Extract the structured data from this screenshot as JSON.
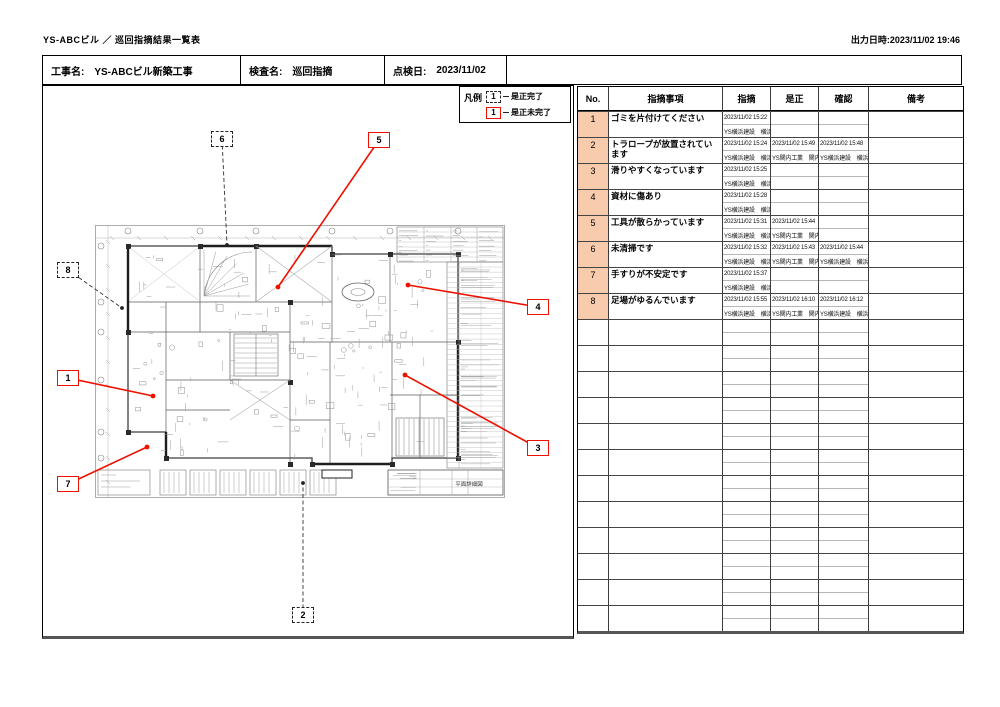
{
  "colors": {
    "accent_red": "#ee1100",
    "no_column_bg": "#f8cbad",
    "marker_dashed": "#222222"
  },
  "page": {
    "title": "YS-ABCビル ／ 巡回指摘結果一覧表",
    "printed_at": "出力日時:2023/11/02 19:46"
  },
  "info_bar": {
    "project_label": "工事名:",
    "project_value": "YS-ABCビル新築工事",
    "inspection_label": "検査名:",
    "inspection_value": "巡回指摘",
    "date_label": "点検日:",
    "date_value": "2023/11/02"
  },
  "legend": {
    "title": "凡例",
    "completed_num": "1",
    "completed_label": "是正完了",
    "incomplete_num": "1",
    "incomplete_label": "是正未完了"
  },
  "plan": {
    "title_block_text": "平面詳細図"
  },
  "table": {
    "headers": [
      "No.",
      "指摘事項",
      "指摘",
      "是正",
      "確認",
      "備考"
    ],
    "empty_row_count": 12,
    "rows": [
      {
        "no": "1",
        "item": "ゴミを片付けてください",
        "shiteki_dt": "2023/11/02 15:22",
        "shiteki_by": "YS横浜建設　横浜",
        "zesei_dt": "",
        "zesei_by": "",
        "kakunin_dt": "",
        "kakunin_by": "",
        "biko": ""
      },
      {
        "no": "2",
        "item": "トラロープが放置されています",
        "shiteki_dt": "2023/11/02 15:24",
        "shiteki_by": "YS横浜建設　横浜",
        "zesei_dt": "2023/11/02 15:49",
        "zesei_by": "YS関内工業　関内",
        "kakunin_dt": "2023/11/02 15:48",
        "kakunin_by": "YS横浜建設　横浜",
        "biko": ""
      },
      {
        "no": "3",
        "item": "滑りやすくなっています",
        "shiteki_dt": "2023/11/02 15:25",
        "shiteki_by": "YS横浜建設　横浜",
        "zesei_dt": "",
        "zesei_by": "",
        "kakunin_dt": "",
        "kakunin_by": "",
        "biko": ""
      },
      {
        "no": "4",
        "item": "資材に傷あり",
        "shiteki_dt": "2023/11/02 15:28",
        "shiteki_by": "YS横浜建設　横浜",
        "zesei_dt": "",
        "zesei_by": "",
        "kakunin_dt": "",
        "kakunin_by": "",
        "biko": ""
      },
      {
        "no": "5",
        "item": "工具が散らかっています",
        "shiteki_dt": "2023/11/02 15:31",
        "shiteki_by": "YS横浜建設　横浜",
        "zesei_dt": "2023/11/02 15:44",
        "zesei_by": "YS関内工業　関内",
        "kakunin_dt": "",
        "kakunin_by": "",
        "biko": ""
      },
      {
        "no": "6",
        "item": "未清掃です",
        "shiteki_dt": "2023/11/02 15:32",
        "shiteki_by": "YS横浜建設　横浜",
        "zesei_dt": "2023/11/02 15:43",
        "zesei_by": "YS関内工業　関内",
        "kakunin_dt": "2023/11/02 15:44",
        "kakunin_by": "YS横浜建設　横浜",
        "biko": ""
      },
      {
        "no": "7",
        "item": "手すりが不安定です",
        "shiteki_dt": "2023/11/02 15:37",
        "shiteki_by": "YS横浜建設　横浜",
        "zesei_dt": "",
        "zesei_by": "",
        "kakunin_dt": "",
        "kakunin_by": "",
        "biko": ""
      },
      {
        "no": "8",
        "item": "足場がゆるんでいます",
        "shiteki_dt": "2023/11/02 15:55",
        "shiteki_by": "YS横浜建設　横浜",
        "zesei_dt": "2023/11/02 16:10",
        "zesei_by": "YS関内工業　関内",
        "kakunin_dt": "2023/11/02 16:12",
        "kakunin_by": "YS横浜建設　横浜",
        "biko": ""
      }
    ]
  },
  "markers": [
    {
      "no": "1",
      "status": "incomplete",
      "box": {
        "x": 57,
        "y": 370
      },
      "dot": {
        "x": 153,
        "y": 396
      }
    },
    {
      "no": "2",
      "status": "completed",
      "box": {
        "x": 292,
        "y": 607
      },
      "dot": {
        "x": 303,
        "y": 483
      }
    },
    {
      "no": "3",
      "status": "incomplete",
      "box": {
        "x": 527,
        "y": 440
      },
      "dot": {
        "x": 405,
        "y": 375
      }
    },
    {
      "no": "4",
      "status": "incomplete",
      "box": {
        "x": 527,
        "y": 299
      },
      "dot": {
        "x": 408,
        "y": 285
      }
    },
    {
      "no": "5",
      "status": "incomplete",
      "box": {
        "x": 368,
        "y": 132
      },
      "dot": {
        "x": 278,
        "y": 287
      }
    },
    {
      "no": "6",
      "status": "completed",
      "box": {
        "x": 211,
        "y": 131
      },
      "dot": {
        "x": 227,
        "y": 245
      }
    },
    {
      "no": "7",
      "status": "incomplete",
      "box": {
        "x": 57,
        "y": 476
      },
      "dot": {
        "x": 147,
        "y": 447
      }
    },
    {
      "no": "8",
      "status": "completed",
      "box": {
        "x": 57,
        "y": 262
      },
      "dot": {
        "x": 122,
        "y": 308
      }
    }
  ]
}
